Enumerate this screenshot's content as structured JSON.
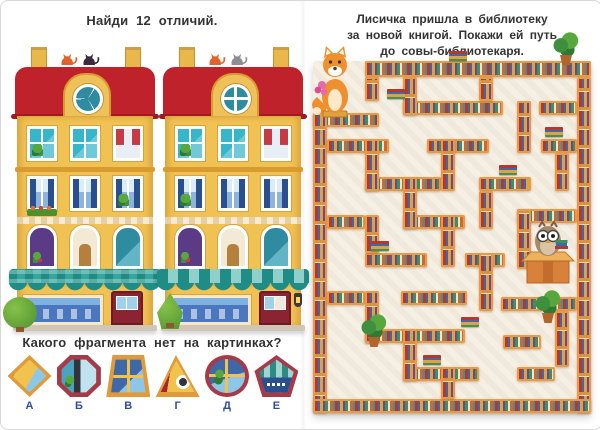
{
  "left_page": {
    "title": "Найди  12  отличий.",
    "question": "Какого  фрагмента  нет  на  картинках?",
    "fragments": [
      {
        "letter": "А",
        "shape": "diamond"
      },
      {
        "letter": "Б",
        "shape": "octagon"
      },
      {
        "letter": "В",
        "shape": "trapezoid"
      },
      {
        "letter": "Г",
        "shape": "triangle"
      },
      {
        "letter": "Д",
        "shape": "circle"
      },
      {
        "letter": "Е",
        "shape": "pentagon"
      }
    ],
    "buildings": {
      "count": 2,
      "description": "two nearly identical yellow shop houses with red mansard roofs, cats on the ridge, teal awnings"
    }
  },
  "right_page": {
    "caption_lines": [
      "Лисичка  пришла  в  библиотеку",
      "за  новой  книгой.  Покажи  ей  путь",
      "до  совы-библиотекаря."
    ],
    "maze": {
      "walls": [
        [
          52,
          0,
          226,
          16
        ],
        [
          52,
          16,
          14,
          24
        ],
        [
          0,
          52,
          66,
          14
        ],
        [
          0,
          52,
          14,
          300
        ],
        [
          264,
          16,
          14,
          336
        ],
        [
          0,
          338,
          278,
          14
        ],
        [
          90,
          40,
          100,
          14
        ],
        [
          226,
          40,
          38,
          14
        ],
        [
          14,
          78,
          62,
          14
        ],
        [
          114,
          78,
          62,
          14
        ],
        [
          228,
          78,
          36,
          14
        ],
        [
          52,
          116,
          76,
          14
        ],
        [
          166,
          116,
          52,
          14
        ],
        [
          14,
          154,
          38,
          14
        ],
        [
          90,
          154,
          62,
          14
        ],
        [
          204,
          148,
          60,
          14
        ],
        [
          52,
          192,
          62,
          14
        ],
        [
          152,
          192,
          40,
          14
        ],
        [
          14,
          230,
          38,
          14
        ],
        [
          88,
          230,
          66,
          14
        ],
        [
          188,
          236,
          76,
          14
        ],
        [
          52,
          268,
          100,
          14
        ],
        [
          190,
          274,
          38,
          14
        ],
        [
          90,
          306,
          76,
          14
        ],
        [
          204,
          306,
          38,
          14
        ],
        [
          90,
          16,
          14,
          38
        ],
        [
          166,
          16,
          14,
          24
        ],
        [
          204,
          40,
          14,
          52
        ],
        [
          52,
          78,
          14,
          52
        ],
        [
          128,
          78,
          14,
          52
        ],
        [
          242,
          92,
          14,
          38
        ],
        [
          90,
          116,
          14,
          52
        ],
        [
          166,
          130,
          14,
          38
        ],
        [
          128,
          154,
          14,
          52
        ],
        [
          204,
          148,
          14,
          60
        ],
        [
          52,
          154,
          14,
          38
        ],
        [
          166,
          192,
          14,
          58
        ],
        [
          52,
          230,
          14,
          52
        ],
        [
          242,
          250,
          14,
          56
        ],
        [
          90,
          268,
          14,
          52
        ],
        [
          128,
          306,
          14,
          32
        ]
      ],
      "decorations": [
        {
          "type": "plant",
          "x": 240,
          "y": -30
        },
        {
          "type": "plant",
          "x": 48,
          "y": 252
        },
        {
          "type": "plant",
          "x": 222,
          "y": 228
        },
        {
          "type": "books",
          "x": 136,
          "y": -10
        },
        {
          "type": "books",
          "x": 74,
          "y": 28
        },
        {
          "type": "books",
          "x": 232,
          "y": 66
        },
        {
          "type": "books",
          "x": 186,
          "y": 104
        },
        {
          "type": "books",
          "x": 58,
          "y": 180
        },
        {
          "type": "books",
          "x": 148,
          "y": 256
        },
        {
          "type": "books",
          "x": 110,
          "y": 294
        }
      ],
      "start_character": "fox with flowers",
      "goal_character": "owl librarian at desk"
    }
  },
  "colors": {
    "roof_red": "#c0222c",
    "facade_yellow": "#f0c253",
    "awning_teal": "#1f8c85",
    "shelf_wood": "#e89a44",
    "maze_floor": "#f5efe4",
    "letter_blue": "#2b4f9e",
    "fox_orange": "#ef8f2e",
    "cats": {
      "left_building": [
        "#e2622b",
        "#3a2a3c"
      ],
      "right_building": [
        "#e2622b",
        "#8d8d96"
      ]
    }
  }
}
